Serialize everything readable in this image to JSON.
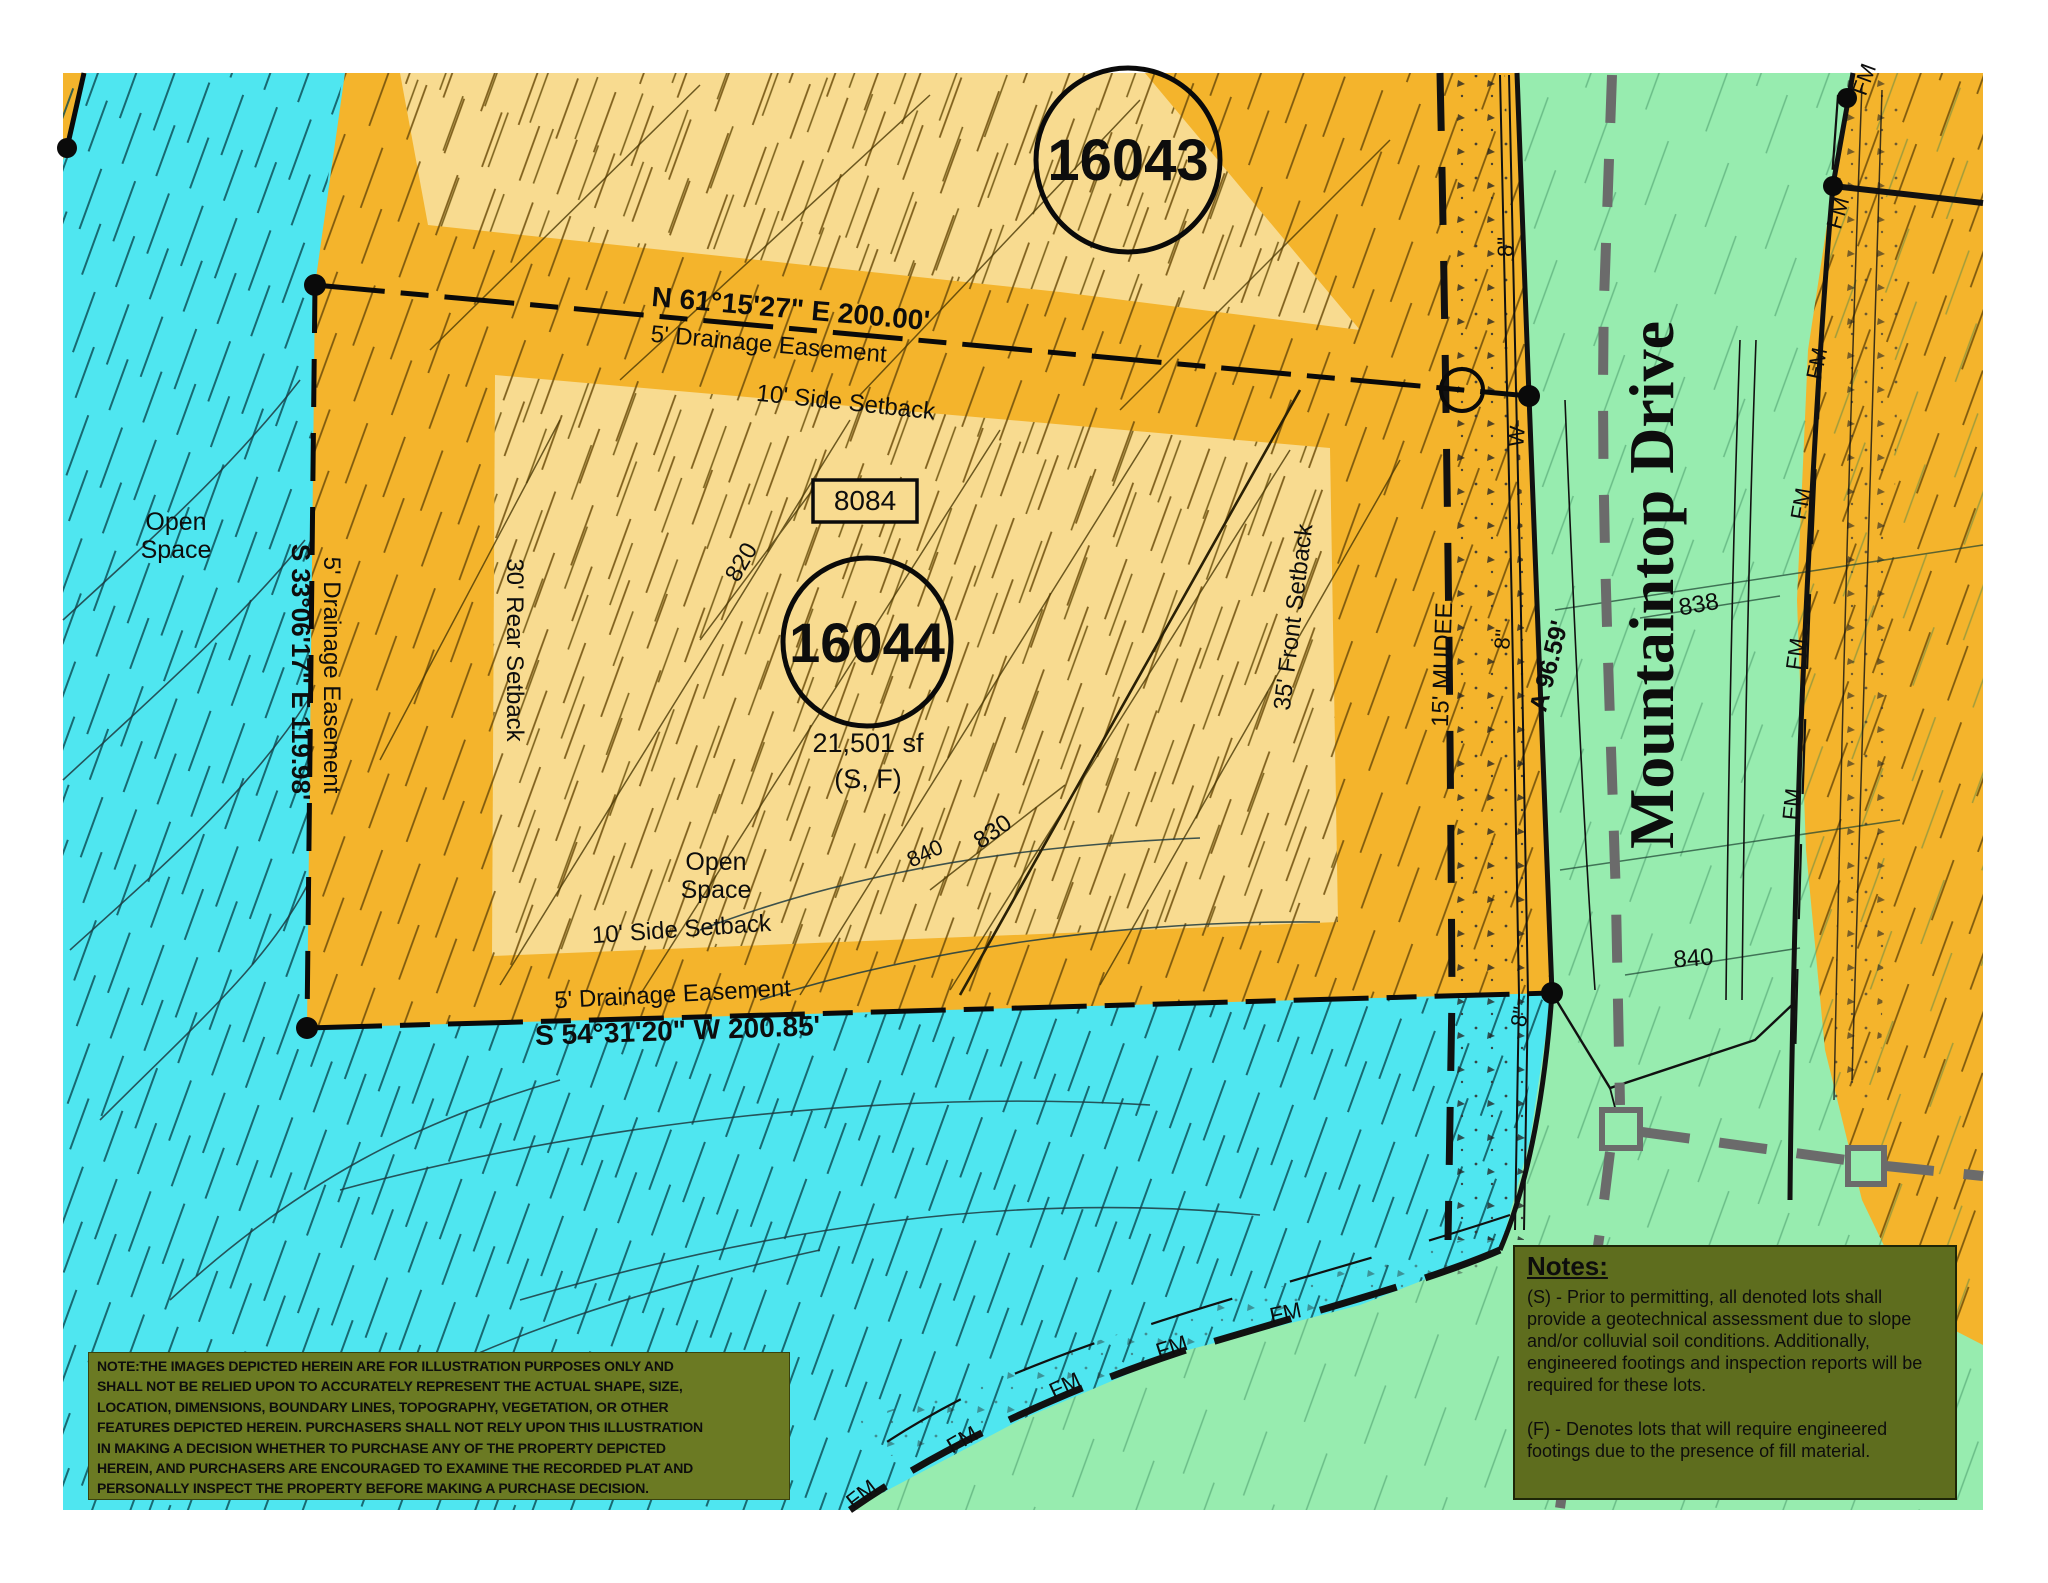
{
  "title": "Plat illustration - Lots 16043 and 16044, Mountaintop Drive",
  "colors": {
    "open_space_cyan": "#4fe6f0",
    "lot_orange": "#f4b42c",
    "lot_interior_pale": "#f8db90",
    "street_green": "#97ecaf",
    "notes_olive": "#5e6d1e",
    "disclaimer_olive": "#6b7a23",
    "gray_dash": "#6b6b6b",
    "line_black": "#111111"
  },
  "lots": {
    "lot_16043": {
      "number": "16043"
    },
    "lot_16044": {
      "number": "16044",
      "area": "21,501 sf",
      "flags": "(S, F)",
      "address": "8084"
    }
  },
  "street": {
    "name": "Mountaintop Drive"
  },
  "labels": [
    {
      "id": "lot-16043-number",
      "text": "16043",
      "x": 1128,
      "y": 180,
      "rot": 0,
      "size": 58,
      "w": 700
    },
    {
      "id": "lot-16044-number",
      "text": "16044",
      "x": 867,
      "y": 662,
      "rot": 0,
      "size": 56,
      "w": 700
    },
    {
      "id": "lot-16044-area",
      "text": "21,501 sf",
      "x": 868,
      "y": 752,
      "rot": 0,
      "size": 27,
      "w": 400
    },
    {
      "id": "lot-16044-flags",
      "text": "(S, F)",
      "x": 868,
      "y": 788,
      "rot": 0,
      "size": 27,
      "w": 400
    },
    {
      "id": "lot-16044-address",
      "text": "8084",
      "x": 865,
      "y": 510,
      "rot": 0,
      "size": 28,
      "w": 400
    },
    {
      "id": "bearing-north",
      "text": "N 61°15'27\" E   200.00'",
      "x": 790,
      "y": 318,
      "rot": 5,
      "size": 28,
      "w": 700
    },
    {
      "id": "easement-label-top",
      "text": "5' Drainage Easement",
      "x": 768,
      "y": 352,
      "rot": 5,
      "size": 24,
      "w": 400
    },
    {
      "id": "setback-side-top",
      "text": "10' Side Setback",
      "x": 845,
      "y": 410,
      "rot": 6,
      "size": 24,
      "w": 400
    },
    {
      "id": "setback-rear",
      "text": "30' Rear Setback",
      "x": 507,
      "y": 650,
      "rot": 90,
      "size": 24,
      "w": 400
    },
    {
      "id": "easement-label-left",
      "text": "5' Drainage Easement",
      "x": 324,
      "y": 675,
      "rot": 90,
      "size": 24,
      "w": 400
    },
    {
      "id": "bearing-west",
      "text": "S 33°06'17\" E  119.98'",
      "x": 292,
      "y": 672,
      "rot": 90,
      "size": 26,
      "w": 700
    },
    {
      "id": "setback-side-bottom",
      "text": "10' Side Setback",
      "x": 682,
      "y": 937,
      "rot": -4,
      "size": 24,
      "w": 400
    },
    {
      "id": "easement-label-bottom",
      "text": "5' Drainage Easement",
      "x": 673,
      "y": 1002,
      "rot": -3,
      "size": 24,
      "w": 400
    },
    {
      "id": "bearing-south",
      "text": "S 54°31'20\" W   200.85'",
      "x": 678,
      "y": 1040,
      "rot": -2,
      "size": 28,
      "w": 700
    },
    {
      "id": "setback-front",
      "text": "35' Front Setback",
      "x": 1301,
      "y": 618,
      "rot": -83,
      "size": 24,
      "w": 400
    },
    {
      "id": "mudee-label",
      "text": "15' MUDEE",
      "x": 1450,
      "y": 665,
      "rot": -88,
      "size": 24,
      "w": 400
    },
    {
      "id": "arc-length",
      "text": "A 96.59'",
      "x": 1557,
      "y": 668,
      "rot": -76,
      "size": 25,
      "w": 700
    },
    {
      "id": "water-8-top",
      "text": "8\"",
      "x": 1513,
      "y": 247,
      "rot": -90,
      "size": 22,
      "w": 400
    },
    {
      "id": "water-w",
      "text": "W",
      "x": 1524,
      "y": 437,
      "rot": -85,
      "size": 22,
      "w": 400
    },
    {
      "id": "water-8-mid",
      "text": "8\"",
      "x": 1510,
      "y": 640,
      "rot": -85,
      "size": 22,
      "w": 400
    },
    {
      "id": "water-8-low",
      "text": "8\"",
      "x": 1527,
      "y": 1018,
      "rot": -80,
      "size": 22,
      "w": 400
    },
    {
      "id": "street-name",
      "text": "Mountaintop Drive",
      "x": 1673,
      "y": 585,
      "rot": -90,
      "size": 64,
      "w": 700,
      "font": "serif"
    },
    {
      "id": "contour-838",
      "text": "838",
      "x": 1700,
      "y": 612,
      "rot": -10,
      "size": 24,
      "w": 400
    },
    {
      "id": "contour-840-street",
      "text": "840",
      "x": 1694,
      "y": 966,
      "rot": -4,
      "size": 24,
      "w": 400
    },
    {
      "id": "contour-840-open",
      "text": "840",
      "x": 928,
      "y": 860,
      "rot": -25,
      "size": 22,
      "w": 400
    },
    {
      "id": "contour-830",
      "text": "830",
      "x": 997,
      "y": 838,
      "rot": -35,
      "size": 24,
      "w": 400
    },
    {
      "id": "contour-820",
      "text": "820",
      "x": 748,
      "y": 566,
      "rot": -60,
      "size": 24,
      "w": 400
    },
    {
      "id": "open-space-1-line1",
      "text": "Open",
      "x": 176,
      "y": 530,
      "rot": 0,
      "size": 25,
      "w": 400
    },
    {
      "id": "open-space-1-line2",
      "text": "Space",
      "x": 176,
      "y": 558,
      "rot": 0,
      "size": 25,
      "w": 400
    },
    {
      "id": "open-space-2-line1",
      "text": "Open",
      "x": 716,
      "y": 870,
      "rot": 0,
      "size": 25,
      "w": 400
    },
    {
      "id": "open-space-2-line2",
      "text": "Space",
      "x": 716,
      "y": 898,
      "rot": 0,
      "size": 25,
      "w": 400
    },
    {
      "id": "fm-bottom-1",
      "text": "FM",
      "x": 866,
      "y": 1500,
      "rot": -38,
      "size": 22,
      "w": 400
    },
    {
      "id": "fm-bottom-2",
      "text": "FM",
      "x": 966,
      "y": 1446,
      "rot": -30,
      "size": 22,
      "w": 400
    },
    {
      "id": "fm-bottom-3",
      "text": "FM",
      "x": 1068,
      "y": 1392,
      "rot": -25,
      "size": 22,
      "w": 400
    },
    {
      "id": "fm-bottom-4",
      "text": "FM",
      "x": 1174,
      "y": 1354,
      "rot": -18,
      "size": 22,
      "w": 400
    },
    {
      "id": "fm-bottom-5",
      "text": "FM",
      "x": 1287,
      "y": 1320,
      "rot": -12,
      "size": 22,
      "w": 400
    },
    {
      "id": "fm-right-0",
      "text": "FM",
      "x": 1871,
      "y": 82,
      "rot": -70,
      "size": 22,
      "w": 400
    },
    {
      "id": "fm-right-1",
      "text": "FM",
      "x": 1845,
      "y": 215,
      "rot": -74,
      "size": 22,
      "w": 400
    },
    {
      "id": "fm-right-2",
      "text": "FM",
      "x": 1824,
      "y": 365,
      "rot": -78,
      "size": 22,
      "w": 400
    },
    {
      "id": "fm-right-3",
      "text": "FM",
      "x": 1808,
      "y": 505,
      "rot": -80,
      "size": 22,
      "w": 400
    },
    {
      "id": "fm-right-4",
      "text": "FM",
      "x": 1803,
      "y": 655,
      "rot": -82,
      "size": 22,
      "w": 400
    },
    {
      "id": "fm-right-5",
      "text": "FM",
      "x": 1799,
      "y": 805,
      "rot": -84,
      "size": 22,
      "w": 400
    }
  ],
  "notes_box": {
    "title": "Notes:",
    "paragraph_s": "(S) -  Prior to permitting, all denoted lots shall provide a geotechnical assessment due to slope and/or colluvial soil conditions.  Additionally, engineered footings and inspection reports will be required for these lots.",
    "paragraph_f": "(F) - Denotes lots that will require engineered footings due to the presence of fill material."
  },
  "disclaimer_box": {
    "lines": [
      "NOTE:THE IMAGES DEPICTED HEREIN ARE FOR ILLUSTRATION PURPOSES ONLY AND",
      "SHALL NOT BE RELIED UPON TO ACCURATELY REPRESENT THE ACTUAL SHAPE, SIZE,",
      "LOCATION, DIMENSIONS, BOUNDARY LINES, TOPOGRAPHY, VEGETATION, OR OTHER",
      "FEATURES DEPICTED HEREIN. PURCHASERS SHALL NOT RELY UPON THIS ILLUSTRATION",
      "IN MAKING A DECISION WHETHER TO PURCHASE ANY OF THE PROPERTY DEPICTED",
      "HEREIN, AND PURCHASERS ARE ENCOURAGED TO EXAMINE THE RECORDED PLAT AND",
      "PERSONALLY INSPECT THE PROPERTY BEFORE MAKING A PURCHASE DECISION."
    ]
  }
}
